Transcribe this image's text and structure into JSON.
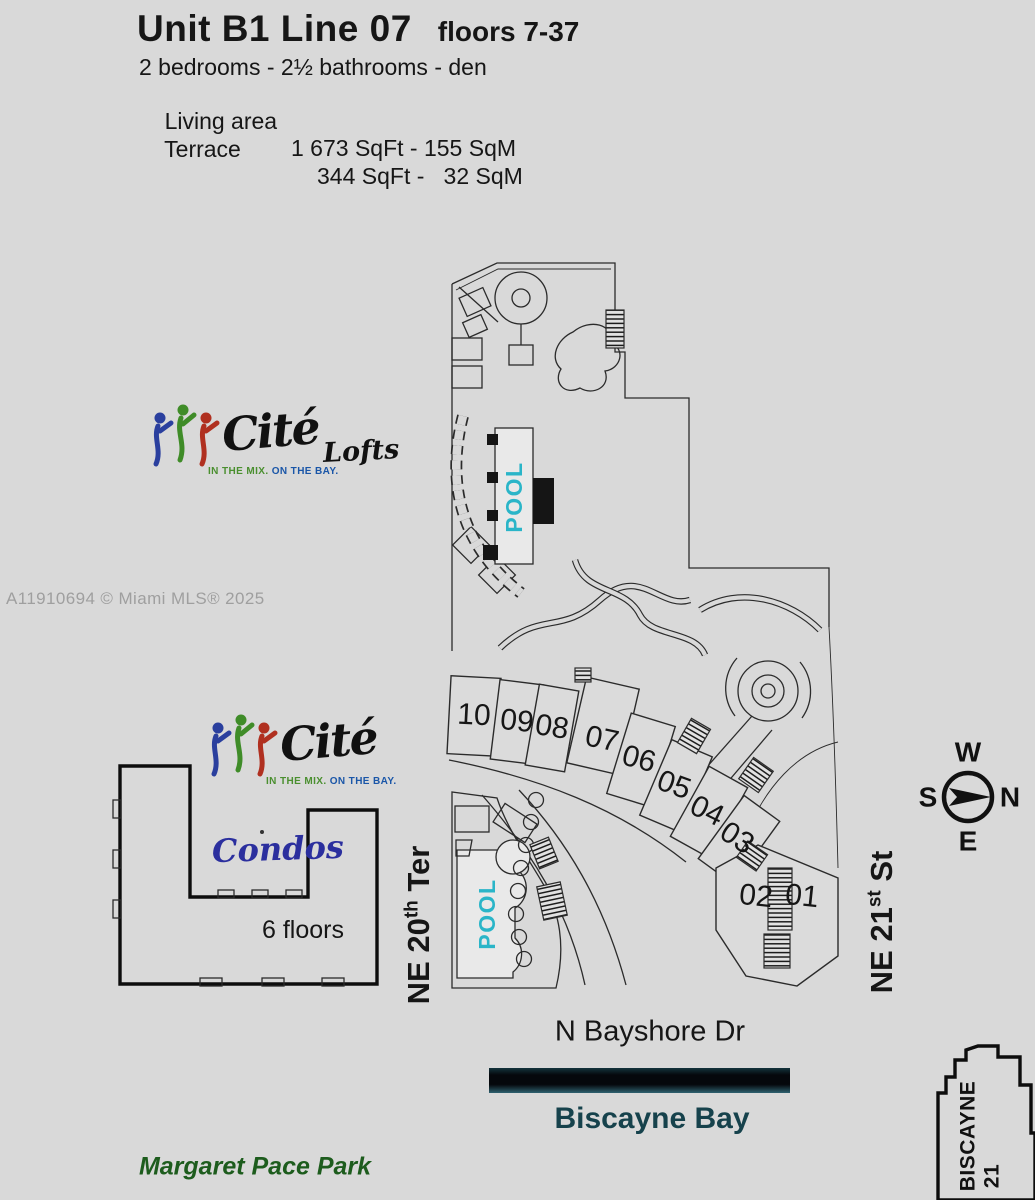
{
  "header": {
    "title": "Unit B1  Line 07",
    "floors": "floors 7-37",
    "subtitle": "2 bedrooms - 2½ bathrooms - den",
    "living_label": "Living area",
    "living_value": "1 673 SqFt - 155 SqM",
    "terrace_label": "Terrace",
    "terrace_value": "344 SqFt -   32 SqM"
  },
  "watermark": "A11910694 © Miami MLS® 2025",
  "logo": {
    "brand": "Cité",
    "tagline_mix": "IN THE MIX.",
    "tagline_bay": "ON THE BAY.",
    "lofts": "Lofts",
    "condos": "Condos"
  },
  "site": {
    "units": [
      {
        "id": "10"
      },
      {
        "id": "09"
      },
      {
        "id": "08"
      },
      {
        "id": "07"
      },
      {
        "id": "06"
      },
      {
        "id": "05"
      },
      {
        "id": "04"
      },
      {
        "id": "03"
      },
      {
        "id": "02"
      },
      {
        "id": "01"
      }
    ],
    "highlighted_unit": "07",
    "pool_upper": "POOL",
    "pool_lower": "POOL",
    "condos_floors": "6 floors"
  },
  "streets": {
    "ne20_base": "NE 20",
    "ne20_sup": "th",
    "ne20_tail": " Ter",
    "ne21_base": "NE 21",
    "ne21_sup": "st",
    "ne21_tail": " St",
    "bayshore": "N Bayshore Dr"
  },
  "places": {
    "bay": "Biscayne Bay",
    "park": "Margaret Pace Park",
    "neighbor_line1": "BISCAYNE",
    "neighbor_line2": "21"
  },
  "compass": {
    "w": "W",
    "s": "S",
    "n": "N",
    "e": "E"
  },
  "colors": {
    "background": "#d9d9d9",
    "unit_highlight": "#ece32a",
    "pool_text": "#2ab5c8",
    "bay_text": "#16424c",
    "park_text": "#1d5c1d",
    "condos_script": "#2b2f9e",
    "logo_blue": "#2a3f9e",
    "logo_green": "#3f8c28",
    "logo_red": "#b03020",
    "tagline_mix": "#4a8f2f",
    "tagline_bay": "#1a56a8",
    "watermark": "#9f9f9f",
    "plan_line": "#2b2b2b",
    "bay_bar": "#05080c"
  }
}
